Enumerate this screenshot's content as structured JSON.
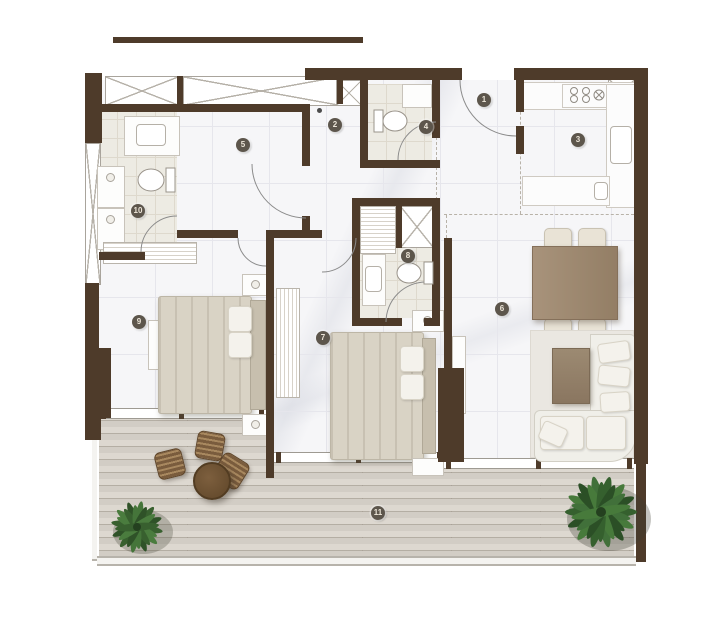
{
  "plan": {
    "room_markers": [
      {
        "number": "1",
        "name": "entrance-foyer"
      },
      {
        "number": "2",
        "name": "hallway"
      },
      {
        "number": "3",
        "name": "kitchen"
      },
      {
        "number": "4",
        "name": "guest-bathroom"
      },
      {
        "number": "5",
        "name": "walk-in-closet"
      },
      {
        "number": "6",
        "name": "living-dining-area"
      },
      {
        "number": "7",
        "name": "bedroom-2"
      },
      {
        "number": "8",
        "name": "ensuite-bathroom"
      },
      {
        "number": "9",
        "name": "master-bedroom"
      },
      {
        "number": "10",
        "name": "master-bathroom"
      },
      {
        "number": "11",
        "name": "terrace"
      }
    ],
    "colors": {
      "wall": "#4e3b2a",
      "marble_floor": "#f6f6f8",
      "bathroom_floor": "#edebe3",
      "wood_deck": "#d7d2c9",
      "furniture_wood": "#97815f",
      "upholstery": "#efeee8",
      "plant_green": "#3f6b38",
      "marker_bg": "#5d564c",
      "marker_text": "#ece5d8"
    },
    "icons": [
      "double-bed",
      "pillow",
      "nightstand",
      "wardrobe",
      "dresser",
      "bench",
      "toilet",
      "washbasin-vanity",
      "washer-dryer",
      "shower",
      "stove",
      "kitchen-sink",
      "dining-table",
      "dining-chair",
      "sofa",
      "coffee-table",
      "area-rug",
      "tv-console",
      "outdoor-table",
      "outdoor-chair",
      "palm-plant",
      "potted-plant",
      "door-swing",
      "sliding-door"
    ]
  }
}
